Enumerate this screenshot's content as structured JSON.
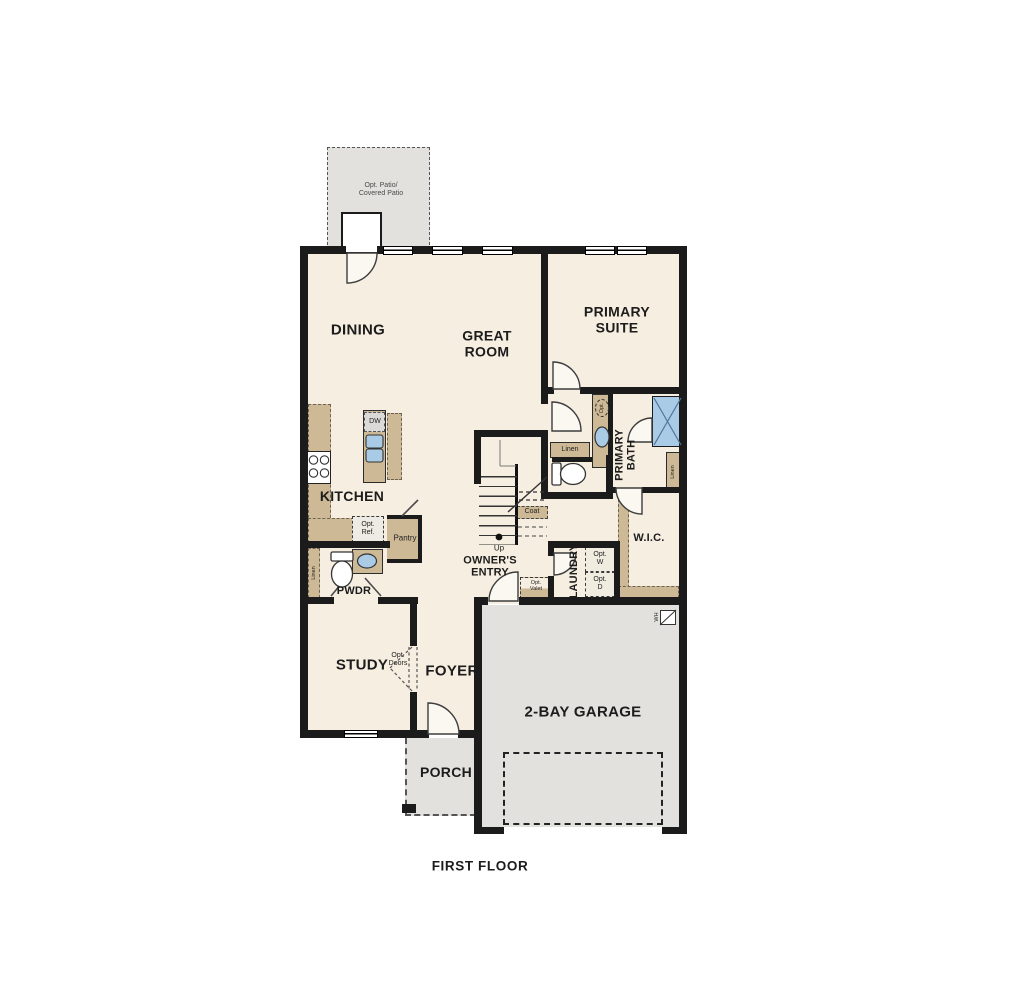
{
  "title": "FIRST FLOOR",
  "rooms": {
    "patio": "Opt. Patio/\nCovered Patio",
    "dining": "DINING",
    "great_room": "GREAT\nROOM",
    "primary_suite": "PRIMARY\nSUITE",
    "kitchen": "KITCHEN",
    "primary_bath": "PRIMARY\nBATH",
    "wic": "W.I.C.",
    "laundry": "LAUNDRY",
    "owners_entry": "OWNER'S\nENTRY",
    "pwdr": "PWDR",
    "study": "STUDY",
    "foyer": "FOYER",
    "porch": "PORCH",
    "garage": "2-BAY GARAGE"
  },
  "labels": {
    "dw": "DW",
    "opt_ref": "Opt.\nRef.",
    "pantry": "Pantry",
    "linen": "Linen",
    "coat": "Coat",
    "up": "Up",
    "opt_w": "Opt.\nW",
    "opt_d": "Opt.\nD",
    "opt_valet": "Opt.\nValet",
    "opt_doors": "Opt.\nDoors",
    "opt_sink": "Opt.",
    "water_heater": "WH"
  },
  "colors": {
    "wall": "#1b1b1b",
    "floor": "#f6efe1",
    "hardscape": "#e3e1dd",
    "cabinet": "#cdb996",
    "fixture_blue": "#a9cbe5"
  }
}
